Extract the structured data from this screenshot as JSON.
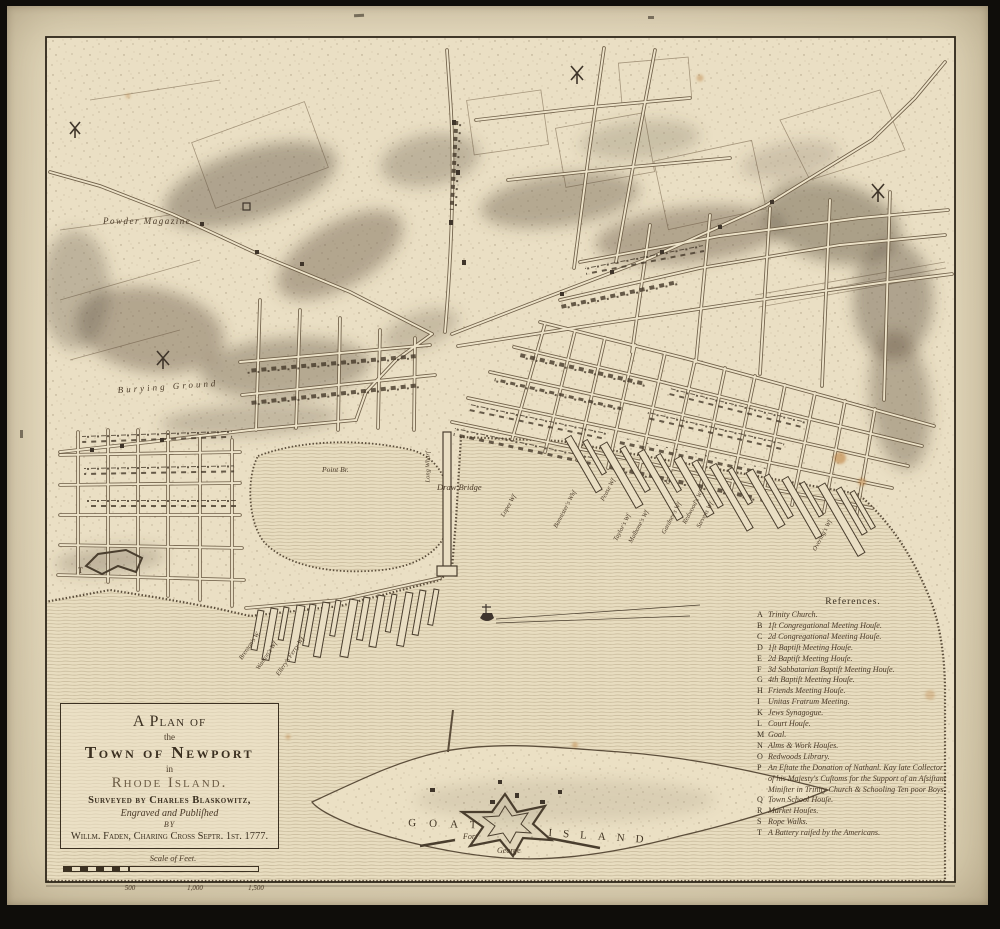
{
  "title_cartouche": {
    "line1": "A Plan of",
    "line2": "the",
    "line3": "Town of Newport",
    "line4": "in",
    "line5": "Rhode Island.",
    "line6": "Surveyed by Charles Blaskowitz,",
    "line7": "Engraved and Publiſhed",
    "line8": "BY",
    "line9": "Willm. Faden, Charing Croſs Septr. 1st. 1777."
  },
  "scale_bar": {
    "label": "Scale of Feet.",
    "ticks": [
      "500",
      "1,000",
      "1,500"
    ]
  },
  "references": {
    "title": "References.",
    "items": [
      {
        "letter": "A",
        "text": "Trinity Church."
      },
      {
        "letter": "B",
        "text": "1ſt Congregational Meeting Houſe."
      },
      {
        "letter": "C",
        "text": "2d Congregational Meeting Houſe."
      },
      {
        "letter": "D",
        "text": "1ſt Baptiſt Meeting Houſe."
      },
      {
        "letter": "E",
        "text": "2d Baptiſt Meeting Houſe."
      },
      {
        "letter": "F",
        "text": "3d Sabbatarian Baptiſt Meeting Houſe."
      },
      {
        "letter": "G",
        "text": "4th Baptiſt Meeting Houſe."
      },
      {
        "letter": "H",
        "text": "Friends Meeting Houſe."
      },
      {
        "letter": "I",
        "text": "Unitas Fratrum Meeting."
      },
      {
        "letter": "K",
        "text": "Jews Synagogue."
      },
      {
        "letter": "L",
        "text": "Court Houſe."
      },
      {
        "letter": "M",
        "text": "Goal."
      },
      {
        "letter": "N",
        "text": "Alms & Work Houſes."
      },
      {
        "letter": "O",
        "text": "Redwoods Library."
      },
      {
        "letter": "P",
        "text": "An Eſtate the Donation of Nathanl. Kay late Collector of his Majesty's Cuſtoms for the Support of an Aſsiſtant Miniſter in Trinity Church & Schooling Ten poor Boys."
      },
      {
        "letter": "Q",
        "text": "Town School Houſe."
      },
      {
        "letter": "R",
        "text": "Market Houſes."
      },
      {
        "letter": "S",
        "text": "Rope Walks."
      },
      {
        "letter": "T",
        "text": "A Battery raiſed by the Americans."
      }
    ]
  },
  "map_labels": {
    "powder_magazine": "Powder Magazine",
    "burying_ground": "Burying Ground",
    "point_br": "Point Br.",
    "draw_bridge": "Draw Bridge",
    "long_wharf": "Long Wharf",
    "lopez_wf": "Lopez Wf",
    "bannisters_wharf": "Bannister's Whf",
    "pease_wf": "Pease Wf",
    "taylors_wf": "Taylor's Wf",
    "malbones_wf": "Malbone's Wf",
    "gardners_wf": "Gardner's Wf",
    "redwoods_wf": "Redwood's Wf",
    "stevens_wf": "Stevens Wf",
    "overings_wf": "Overing's Wf",
    "brentons_w": "Brenton's W.",
    "wantons_wf": "Wanton's Wf",
    "ellerys_wf": "Ellery's Ferry Wf",
    "goat": "Goat",
    "island": "Island",
    "fort": "Fort",
    "george": "George",
    "battery_t": "T"
  },
  "colors": {
    "parchment": "#e9dec3",
    "margin": "#ddd2b4",
    "ink": "#4a3e2e",
    "hill_shade": "#5e5140",
    "water_line": "#bcad8e",
    "foxing": "#b97a36",
    "frame": "#0f0d0a"
  }
}
